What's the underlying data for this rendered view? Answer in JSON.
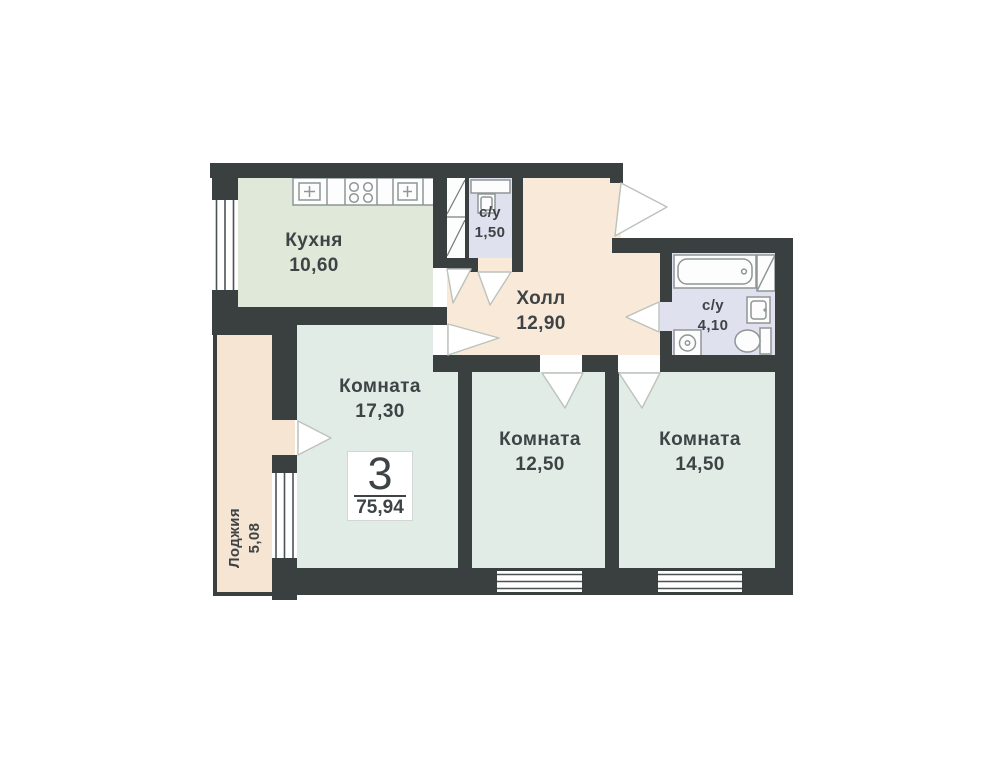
{
  "plan": {
    "badge": {
      "rooms": "3",
      "area": "75,94"
    },
    "rooms": [
      {
        "id": "kitchen",
        "name": "Кухня",
        "area": "10,60"
      },
      {
        "id": "wc-small",
        "name": "с/у",
        "area": "1,50"
      },
      {
        "id": "hall",
        "name": "Холл",
        "area": "12,90"
      },
      {
        "id": "bathroom",
        "name": "с/у",
        "area": "4,10"
      },
      {
        "id": "room-1",
        "name": "Комната",
        "area": "17,30"
      },
      {
        "id": "room-2",
        "name": "Комната",
        "area": "12,50"
      },
      {
        "id": "room-3",
        "name": "Комната",
        "area": "14,50"
      },
      {
        "id": "loggia",
        "name": "Лоджия",
        "area": "5,08"
      }
    ],
    "colors": {
      "wall": "#3a4040",
      "kitchen_floor": "#e0e8da",
      "hall_floor": "#f9e9d8",
      "bathroom_floor": "#dfe2ee",
      "room_floor": "#e2ece7",
      "loggia_floor": "#f7e5d3",
      "fixture_stroke": "#8f9696",
      "window_line": "#4c5354",
      "door_stroke": "#bcc2bc",
      "text": "#3e4446"
    }
  }
}
